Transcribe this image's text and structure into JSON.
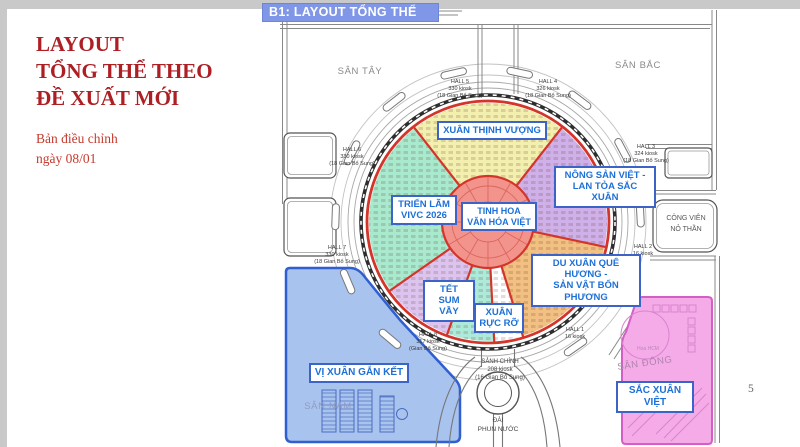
{
  "slide": {
    "title": "LAYOUT\nTỔNG THỂ THEO\nĐỀ XUẤT MỚI",
    "subtitle": "Bản điều chỉnh\nngày 08/01",
    "page_number": "5"
  },
  "header": {
    "title": "B1: LAYOUT TỔNG THỂ"
  },
  "map": {
    "plazas": {
      "west": "SÂN TÂY",
      "north": "SÂN BẮC",
      "south": "SÂN NAM",
      "east": "SÂN ĐÔNG"
    },
    "park": "CÔNG VIÊN\nNỎ THẦN",
    "fountain": "ĐÀI\nPHUN NƯỚC",
    "main_hall": "SẢNH CHÍNH\n208 kiosk\n(16 Gian Bổ Sung)",
    "hoa_hcm": "Hoa HCM",
    "zones": {
      "center": "TINH HOA\nVĂN HÓA VIỆT",
      "north": "XUÂN THỊNH VƯỢNG",
      "east": "NÔNG SẢN VIỆT -\nLAN TỎA SẮC XUÂN",
      "southeast": "DU XUÂN QUÊ HƯƠNG -\nSẢN VẬT BỐN PHƯƠNG",
      "south": "XUÂN\nRỰC RỠ",
      "southwest": "TẾT\nSUM VẦY",
      "west": "TRIỂN LÃM\nVIVC 2026",
      "south_plaza": "VỊ XUÂN GẮN KẾT",
      "east_plaza": "SẮC XUÂN VIỆT"
    },
    "halls": {
      "hall1": "HALL 1\n16 kiosk",
      "hall2": "HALL 2\n16 kiosk",
      "hall3": "HALL 3\n324 kiosk\n(18 Gian Bổ Sung)",
      "hall4": "HALL 4\n326 kiosk\n(18 Gian Bổ Sung)",
      "hall5": "HALL 5\n330 kiosk\n(18 Gian Bổ Sung)",
      "hall6": "HALL 6\n330 kiosk\n(18 Gian Bổ Sung)",
      "hall7": "HALL 7\n330 kiosk\n(18 Gian Bổ Sung)",
      "hall8": "HALL 8\n317 kiosk\n(Gian Bổ Sung)"
    }
  },
  "colors": {
    "title_red": "#ae1f24",
    "subtitle_red": "#c43b2e",
    "header_bg": "#8096e7",
    "header_text": "#ffffff",
    "label_blue": "#1d70d8",
    "label_border": "#3c63c8",
    "ring_red": "#d3352b",
    "hub_fill": "#f2938c",
    "sector_yellow": "#f3efae",
    "sector_purple": "#cfb0e8",
    "sector_orange": "#f3c083",
    "sector_mint": "#aeeada",
    "sector_lavender": "#dcc4ef",
    "sector_green": "#a9e9cd",
    "south_plaza_fill": "#a9c3ef",
    "south_plaza_border": "#2f5fd0",
    "east_plaza_fill": "#f6abe9",
    "east_plaza_border": "#d45fc4",
    "plaza_text": "#8a8a8a"
  }
}
